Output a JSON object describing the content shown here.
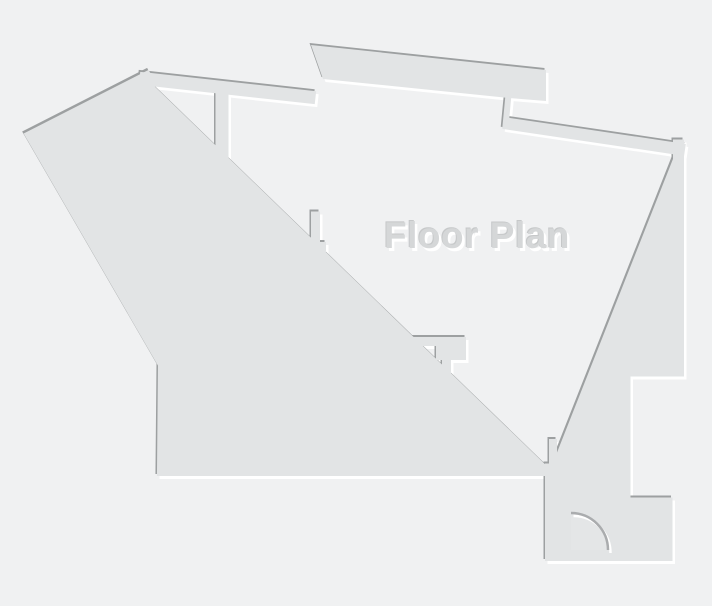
{
  "title": "Floor Plan",
  "canvas": {
    "width": "712",
    "height": "606"
  },
  "colors": {
    "background": "#f0f1f2",
    "wall_fill": "#e2e4e5",
    "wall_edge_dark": "#9da0a1",
    "wall_shadow_white": "#ffffff",
    "title_fill": "#d5d7d8",
    "title_edge_dark": "#c6c8c9",
    "title_shadow_white": "#ffffff",
    "door_swing_fill": "#e4e6e7",
    "door_arc_stroke": "#aaacae"
  },
  "legend": {
    "door": "entry-door-quarter-swing",
    "windows": [
      "right-wall-window-upper",
      "right-wall-window-lower"
    ]
  }
}
